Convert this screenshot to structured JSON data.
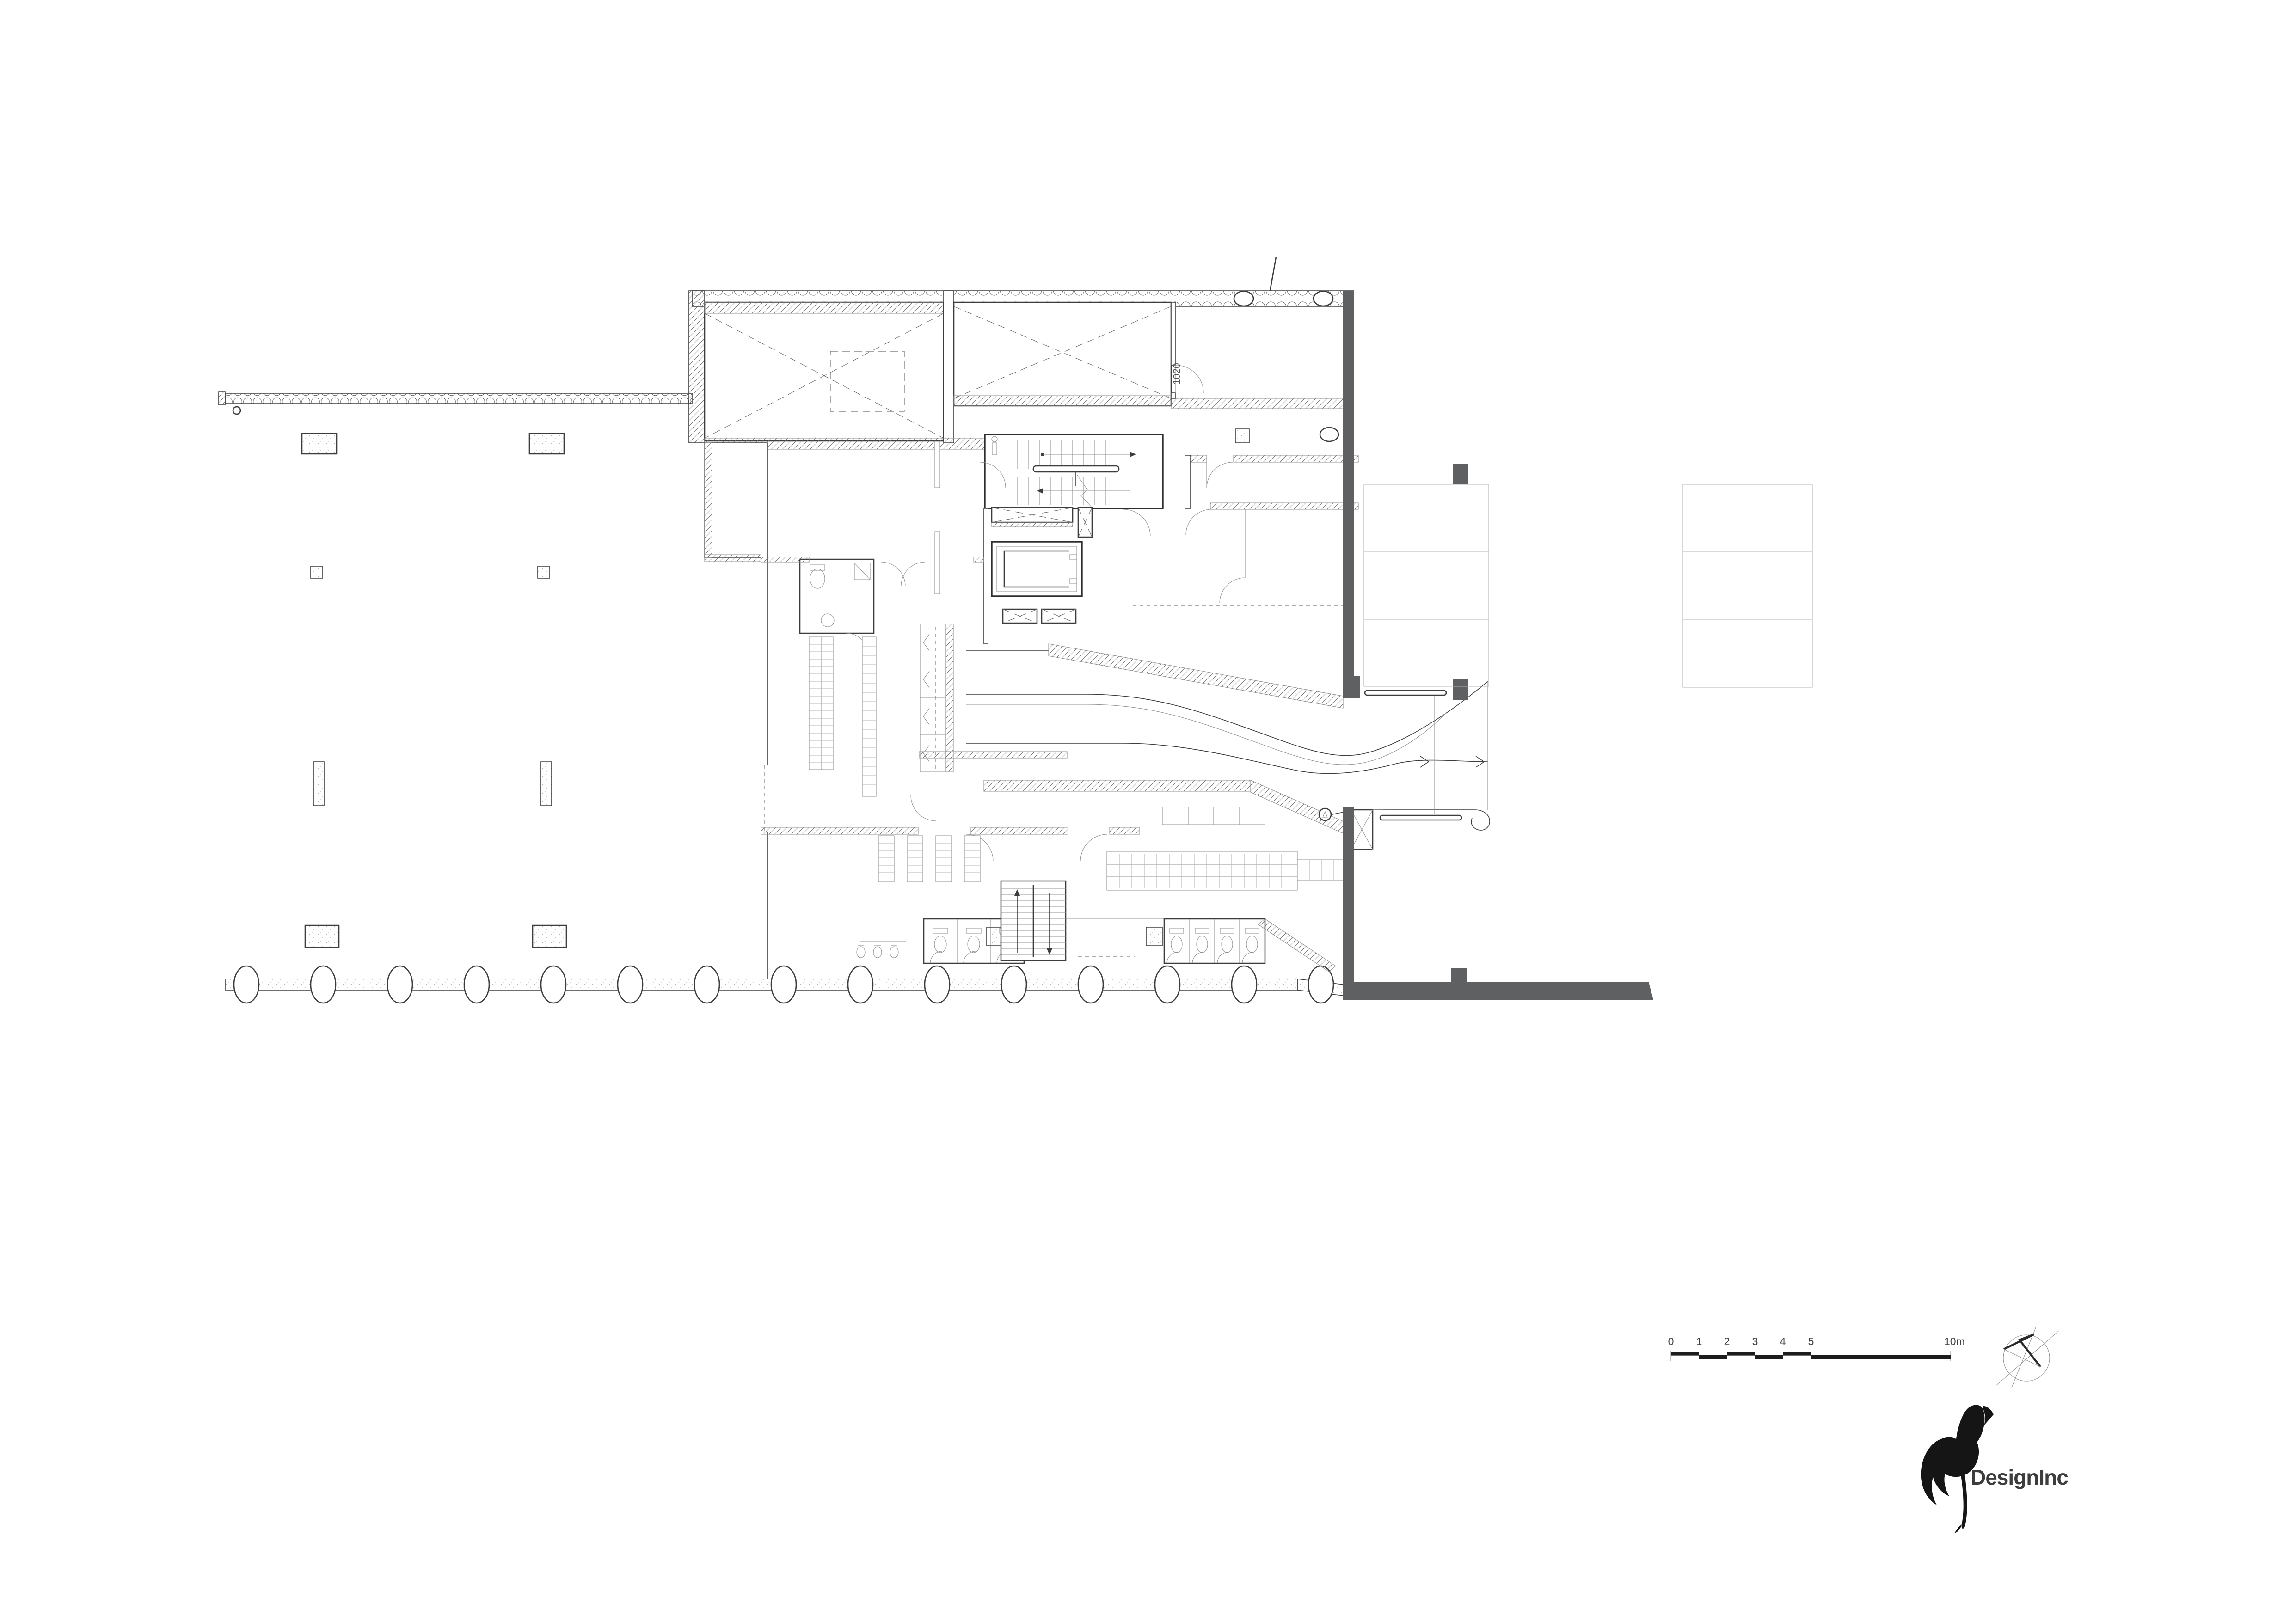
{
  "plan": {
    "door_tag": "1020"
  },
  "scale_bar": {
    "labels": [
      "0",
      "1",
      "2",
      "3",
      "4",
      "5",
      "10m"
    ]
  },
  "logo": {
    "text": "DesignInc",
    "color": "#c8242c"
  },
  "colors": {
    "dark_wall": "#5f6062",
    "line": "#3d3d3d",
    "light_line": "#8f8f8f",
    "bar_black": "#1c1c1c",
    "bird_black": "#151515"
  }
}
